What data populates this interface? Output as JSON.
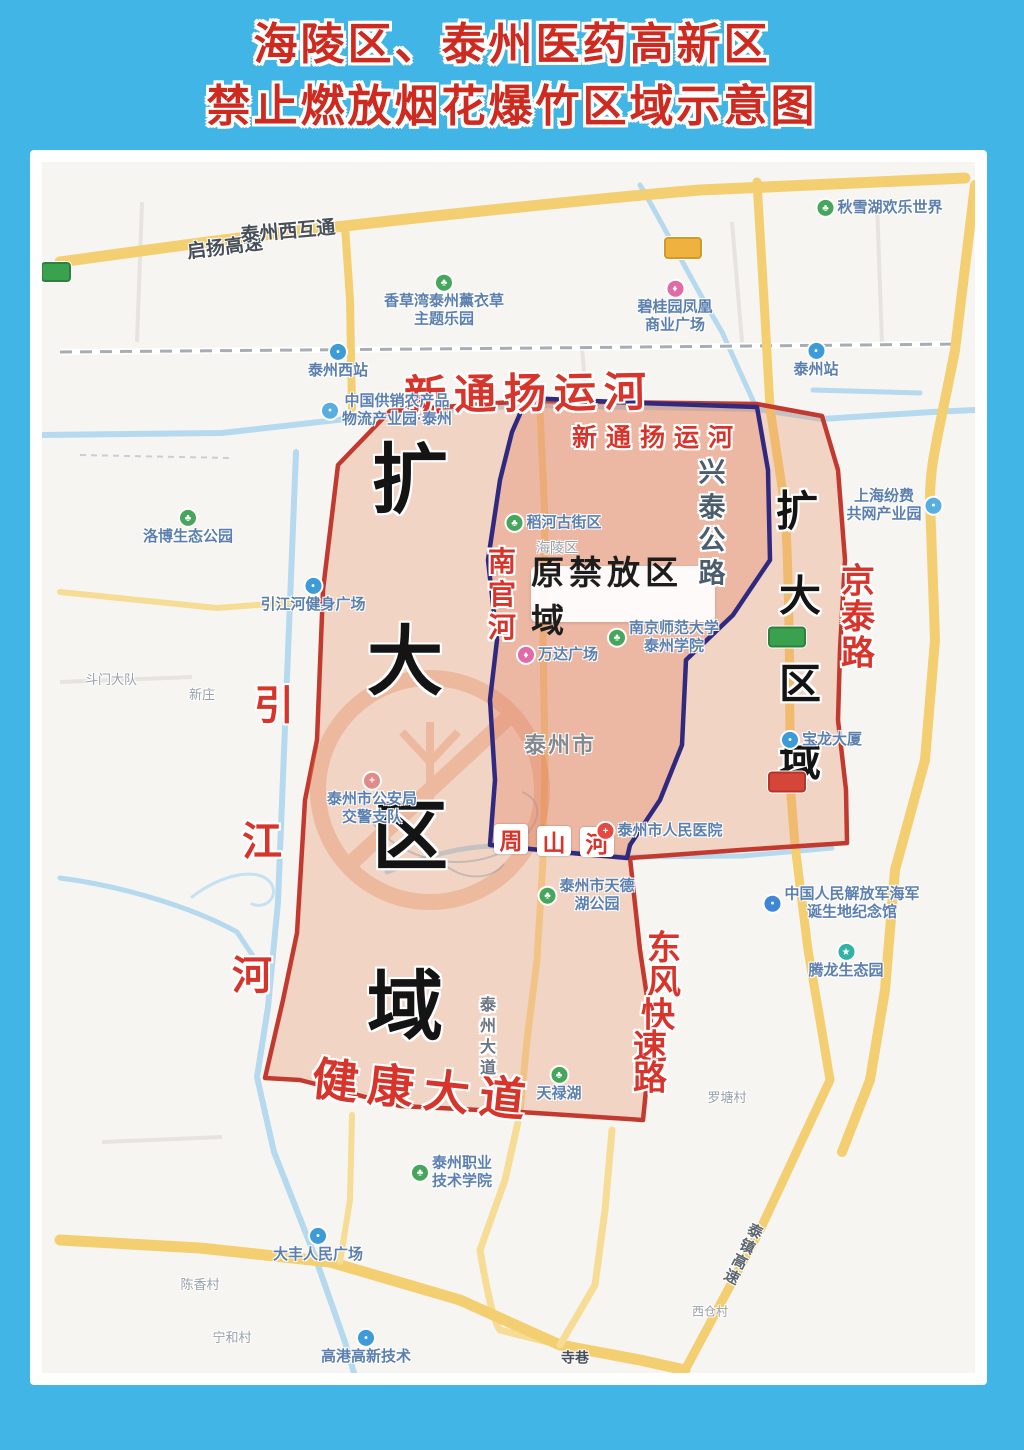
{
  "title": {
    "line1": "海陵区、泰州医药高新区",
    "line2": "禁止燃放烟花爆竹区域示意图"
  },
  "colors": {
    "frame_blue": "#41b5e6",
    "title_red": "#ce2a20",
    "zone_boundary_red": "#c23a2f",
    "zone_boundary_blue": "#2f2a80",
    "zone_fill_salmon": "#eb9270",
    "road_yellow": "#f3cf72",
    "river_blue": "#b5d9ee"
  },
  "zones": {
    "expanded_name": "扩大区域",
    "expanded_chars_left": [
      {
        "c": "扩",
        "x": 368,
        "y": 311
      },
      {
        "c": "大",
        "x": 363,
        "y": 493
      },
      {
        "c": "区",
        "x": 368,
        "y": 668
      },
      {
        "c": "域",
        "x": 363,
        "y": 838
      }
    ],
    "expanded_chars_right": [
      {
        "c": "扩",
        "x": 755,
        "y": 346
      },
      {
        "c": "大",
        "x": 758,
        "y": 431
      },
      {
        "c": "区",
        "x": 758,
        "y": 519
      },
      {
        "c": "域",
        "x": 758,
        "y": 596
      }
    ],
    "original_label": "原禁放区域"
  },
  "road_labels": {
    "xintongyang_canal_outer": "新通扬运河",
    "xintongyang_canal_inner": "新通扬运河",
    "jiankang_avenue": "健康大道",
    "taizhen_expressway": "泰镇高速"
  },
  "char_labels": [
    {
      "c": "引",
      "x": 232,
      "y": 540,
      "s": 40,
      "cls": "redchar"
    },
    {
      "c": "江",
      "x": 220,
      "y": 676,
      "s": 40,
      "cls": "redchar"
    },
    {
      "c": "河",
      "x": 210,
      "y": 810,
      "s": 40,
      "cls": "redchar"
    },
    {
      "c": "南",
      "x": 460,
      "y": 398,
      "s": 28,
      "cls": "redchar"
    },
    {
      "c": "官",
      "x": 460,
      "y": 431,
      "s": 28,
      "cls": "redchar"
    },
    {
      "c": "河",
      "x": 460,
      "y": 464,
      "s": 28,
      "cls": "redchar"
    },
    {
      "c": "京",
      "x": 816,
      "y": 416,
      "s": 34,
      "cls": "redchar"
    },
    {
      "c": "泰",
      "x": 816,
      "y": 452,
      "s": 34,
      "cls": "redchar"
    },
    {
      "c": "路",
      "x": 816,
      "y": 488,
      "s": 34,
      "cls": "redchar"
    },
    {
      "c": "东",
      "x": 622,
      "y": 783,
      "s": 34,
      "cls": "redchar"
    },
    {
      "c": "风",
      "x": 622,
      "y": 817,
      "s": 34,
      "cls": "redchar"
    },
    {
      "c": "快",
      "x": 616,
      "y": 850,
      "s": 34,
      "cls": "redchar"
    },
    {
      "c": "速",
      "x": 608,
      "y": 882,
      "s": 34,
      "cls": "redchar"
    },
    {
      "c": "路",
      "x": 608,
      "y": 913,
      "s": 34,
      "cls": "redchar"
    },
    {
      "c": "兴",
      "x": 670,
      "y": 308,
      "s": 27,
      "cls": "grayv"
    },
    {
      "c": "泰",
      "x": 670,
      "y": 343,
      "s": 27,
      "cls": "grayv"
    },
    {
      "c": "公",
      "x": 670,
      "y": 376,
      "s": 27,
      "cls": "grayv"
    },
    {
      "c": "路",
      "x": 670,
      "y": 409,
      "s": 27,
      "cls": "grayv"
    },
    {
      "c": "泰",
      "x": 446,
      "y": 841,
      "s": 16,
      "cls": "avev"
    },
    {
      "c": "州",
      "x": 446,
      "y": 862,
      "s": 16,
      "cls": "avev"
    },
    {
      "c": "大",
      "x": 446,
      "y": 883,
      "s": 16,
      "cls": "avev"
    },
    {
      "c": "道",
      "x": 446,
      "y": 904,
      "s": 16,
      "cls": "avev"
    }
  ],
  "zhoushan_boxed": [
    {
      "c": "周",
      "x": 469,
      "y": 677
    },
    {
      "c": "山",
      "x": 512,
      "y": 679
    },
    {
      "c": "河",
      "x": 555,
      "y": 680
    }
  ],
  "badges": [
    {
      "x": 641,
      "y": 86,
      "w": 34,
      "h": 18,
      "c": "#efb23e",
      "b": "#cf9a2a",
      "name": "expressway-badge"
    },
    {
      "x": 14,
      "y": 110,
      "w": 26,
      "h": 16,
      "c": "#3aa14f",
      "b": "#2f8040",
      "name": "provincial-road-badge"
    },
    {
      "x": 745,
      "y": 475,
      "w": 34,
      "h": 17,
      "c": "#3aa14f",
      "b": "#2f8040",
      "name": "provincial-road-badge"
    },
    {
      "x": 745,
      "y": 620,
      "w": 34,
      "h": 17,
      "c": "#d4453a",
      "b": "#b33529",
      "name": "national-road-badge"
    }
  ],
  "pois": [
    {
      "id": "qiyang-expressway-label",
      "lines": [
        "启扬高速"
      ],
      "cls": "dark",
      "x": 183,
      "y": 86,
      "rot": -7,
      "fs": 19
    },
    {
      "id": "taizhou-west-interchange-label",
      "lines": [
        "泰州西互通"
      ],
      "cls": "dark",
      "x": 246,
      "y": 70,
      "rot": -5,
      "fs": 19
    },
    {
      "id": "lavender-theme-park",
      "type": "park",
      "layout": "below",
      "lines": [
        "香草湾泰州薰衣草",
        "主题乐园"
      ],
      "x": 402,
      "y": 140
    },
    {
      "id": "taizhou-west-station",
      "type": "station",
      "layout": "below",
      "lines": [
        "泰州西站"
      ],
      "x": 296,
      "y": 200
    },
    {
      "id": "gongxiao-logistics-park",
      "type": "industry",
      "lines": [
        "中国供销农产品",
        "物流产业园·泰州"
      ],
      "x": 345,
      "y": 249
    },
    {
      "id": "qiuxuehu-happy-world",
      "type": "park",
      "lines": [
        "秋雪湖欢乐世界"
      ],
      "x": 838,
      "y": 46
    },
    {
      "id": "biguiyuan-phoenix-plaza",
      "type": "mall",
      "layout": "below",
      "lines": [
        "碧桂园凤凰",
        "商业广场"
      ],
      "x": 633,
      "y": 146
    },
    {
      "id": "taizhou-station",
      "type": "station",
      "layout": "below",
      "lines": [
        "泰州站"
      ],
      "x": 774,
      "y": 199
    },
    {
      "id": "luobo-eco-park",
      "type": "park",
      "layout": "below",
      "lines": [
        "洛博生态公园"
      ],
      "x": 146,
      "y": 366
    },
    {
      "id": "yinjiang-fitness-plaza",
      "type": "station",
      "layout": "below",
      "lines": [
        "引江河健身广场"
      ],
      "x": 271,
      "y": 434
    },
    {
      "id": "doumen-dadui",
      "lines": [
        "斗门大队"
      ],
      "cls": "gray",
      "x": 69,
      "y": 518,
      "fs": 13
    },
    {
      "id": "xinzhuang",
      "lines": [
        "新庄"
      ],
      "cls": "gray",
      "x": 160,
      "y": 533,
      "fs": 13
    },
    {
      "id": "daohe-old-street",
      "type": "park",
      "lines": [
        "稻河古街区"
      ],
      "x": 512,
      "y": 361
    },
    {
      "id": "hailing-district-label",
      "lines": [
        "海陵区"
      ],
      "cls": "gray",
      "x": 515,
      "y": 386,
      "fs": 14
    },
    {
      "id": "wanda-plaza",
      "type": "mall",
      "lines": [
        "万达广场"
      ],
      "x": 516,
      "y": 493
    },
    {
      "id": "nanshida-taizhou-college",
      "type": "park",
      "lines": [
        "南京师范大学",
        "泰州学院"
      ],
      "x": 622,
      "y": 476
    },
    {
      "id": "taizhou-city-label",
      "lines": [
        "泰州市"
      ],
      "cls": "city",
      "x": 518,
      "y": 584,
      "fs": 22
    },
    {
      "id": "traffic-police",
      "type": "police",
      "layout": "below",
      "lines": [
        "泰州市公安局",
        "交警支队"
      ],
      "x": 330,
      "y": 638
    },
    {
      "id": "taizhou-peoples-hospital",
      "type": "hospital",
      "lines": [
        "泰州市人民医院"
      ],
      "x": 618,
      "y": 669
    },
    {
      "id": "tiandehu-park",
      "type": "park",
      "lines": [
        "泰州市天德",
        "湖公园"
      ],
      "x": 545,
      "y": 734
    },
    {
      "id": "navy-birthplace-memorial",
      "type": "museum",
      "lines": [
        "中国人民解放军海军",
        "诞生地纪念馆"
      ],
      "x": 800,
      "y": 742
    },
    {
      "id": "tenglong-eco-area",
      "type": "attraction",
      "layout": "below",
      "lines": [
        "腾龙生态园"
      ],
      "x": 804,
      "y": 800
    },
    {
      "id": "baolong-tower",
      "type": "station",
      "lines": [
        "宝龙大厦"
      ],
      "x": 780,
      "y": 578
    },
    {
      "id": "shanghai-industry-park",
      "type": "industry",
      "layout": "left",
      "lines": [
        "上海纷费",
        "共网产业园"
      ],
      "x": 852,
      "y": 344
    },
    {
      "id": "tianluhu",
      "type": "park",
      "layout": "below",
      "lines": [
        "天禄湖"
      ],
      "x": 517,
      "y": 923
    },
    {
      "id": "taizhou-polytechnic-college",
      "type": "park",
      "lines": [
        "泰州职业",
        "技术学院"
      ],
      "x": 410,
      "y": 1011
    },
    {
      "id": "luotang-village",
      "lines": [
        "罗塘村"
      ],
      "cls": "gray",
      "x": 685,
      "y": 936,
      "fs": 13
    },
    {
      "id": "dafeng-peoples-square",
      "type": "station",
      "layout": "below",
      "lines": [
        "大丰人民广场"
      ],
      "x": 276,
      "y": 1084
    },
    {
      "id": "gaogang-hitech",
      "type": "station",
      "layout": "below",
      "lines": [
        "高港高新技术"
      ],
      "x": 324,
      "y": 1186
    },
    {
      "id": "chenxiang-village",
      "lines": [
        "陈香村"
      ],
      "cls": "gray",
      "x": 158,
      "y": 1123,
      "fs": 13
    },
    {
      "id": "ninghe-village",
      "lines": [
        "宁和村"
      ],
      "cls": "gray",
      "x": 190,
      "y": 1176,
      "fs": 13
    },
    {
      "id": "sixiang",
      "lines": [
        "寺巷"
      ],
      "cls": "dark",
      "x": 533,
      "y": 1196,
      "fs": 14
    },
    {
      "id": "xicang-village",
      "lines": [
        "西仓村"
      ],
      "cls": "gray",
      "x": 668,
      "y": 1150,
      "fs": 12
    }
  ]
}
